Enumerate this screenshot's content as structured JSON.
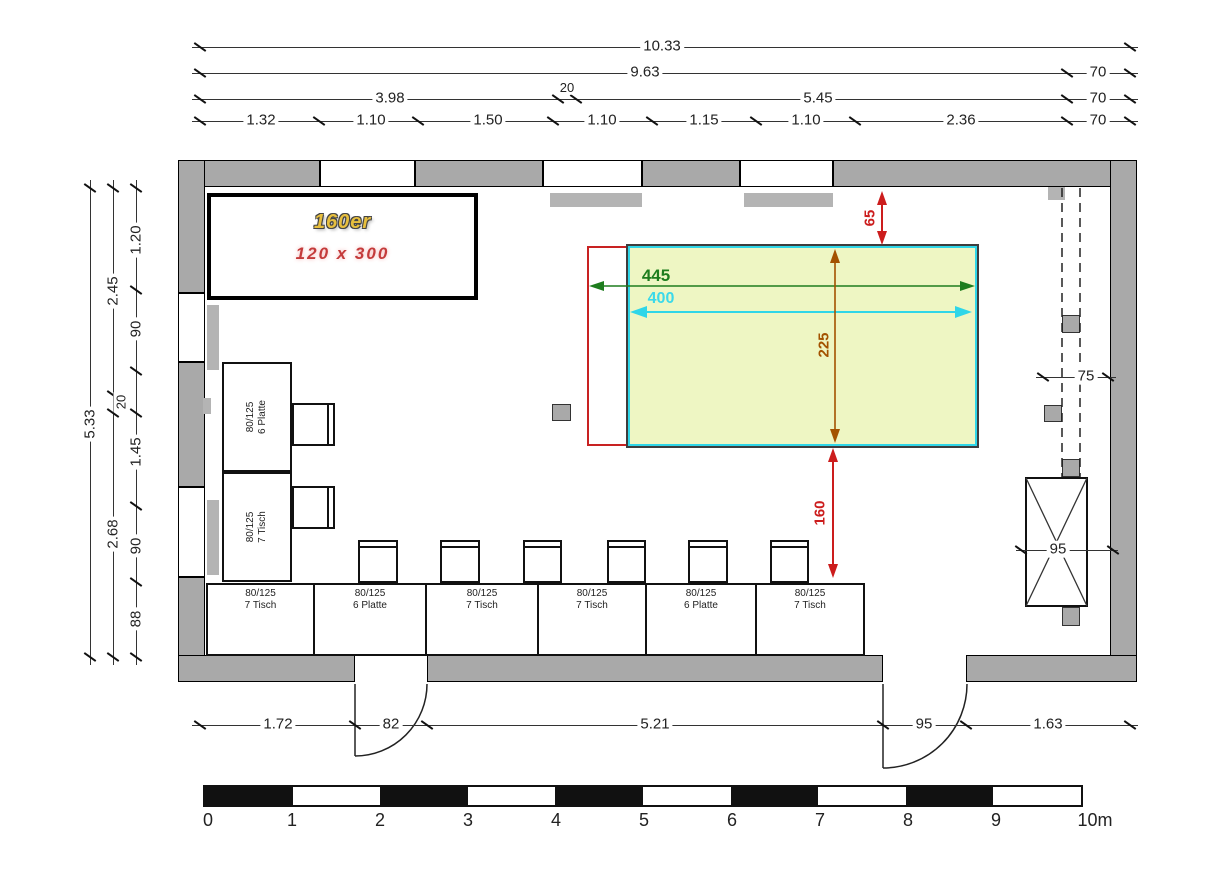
{
  "colors": {
    "wall": "#a9a9a9",
    "red": "#cc1d1d",
    "green": "#1e7d1e",
    "cyan": "#2fd6e8",
    "orange": "#a35200",
    "highlight_fill": "#eef6c3",
    "gold": "#e7bf3e",
    "label_red": "#c43b3b"
  },
  "annotation_box": {
    "title": "160er",
    "subtitle": "120 x 300"
  },
  "highlight": {
    "outer_width": "445",
    "inner_width": "400",
    "height": "225",
    "top_gap": "65",
    "bottom_gap": "160"
  },
  "dims": {
    "top_total": "10.33",
    "top_row2": [
      "9.63",
      "70"
    ],
    "top_row3": [
      "3.98",
      "20",
      "5.45",
      "70"
    ],
    "top_row4": [
      "1.32",
      "1.10",
      "1.50",
      "1.10",
      "1.15",
      "1.10",
      "2.36",
      "70"
    ],
    "left_total": "5.33",
    "left_mid": [
      "2.45",
      "20",
      "2.68"
    ],
    "left_inner": [
      "1.20",
      "90",
      "1.45",
      "90",
      "88"
    ],
    "bottom": [
      "1.72",
      "82",
      "5.21",
      "95",
      "1.63"
    ],
    "right_corridor": "75",
    "right_shaft": "95"
  },
  "furniture": {
    "side_tables": [
      {
        "size": "80/125",
        "label": "6 Platte"
      },
      {
        "size": "80/125",
        "label": "7 Tisch"
      }
    ],
    "bottom_tables": [
      {
        "size": "80/125",
        "label": "7 Tisch"
      },
      {
        "size": "80/125",
        "label": "6 Platte"
      },
      {
        "size": "80/125",
        "label": "7 Tisch"
      },
      {
        "size": "80/125",
        "label": "7 Tisch"
      },
      {
        "size": "80/125",
        "label": "6 Platte"
      },
      {
        "size": "80/125",
        "label": "7 Tisch"
      }
    ]
  },
  "scale_bar": {
    "labels": [
      "0",
      "1",
      "2",
      "3",
      "4",
      "5",
      "6",
      "7",
      "8",
      "9",
      "10m"
    ]
  }
}
